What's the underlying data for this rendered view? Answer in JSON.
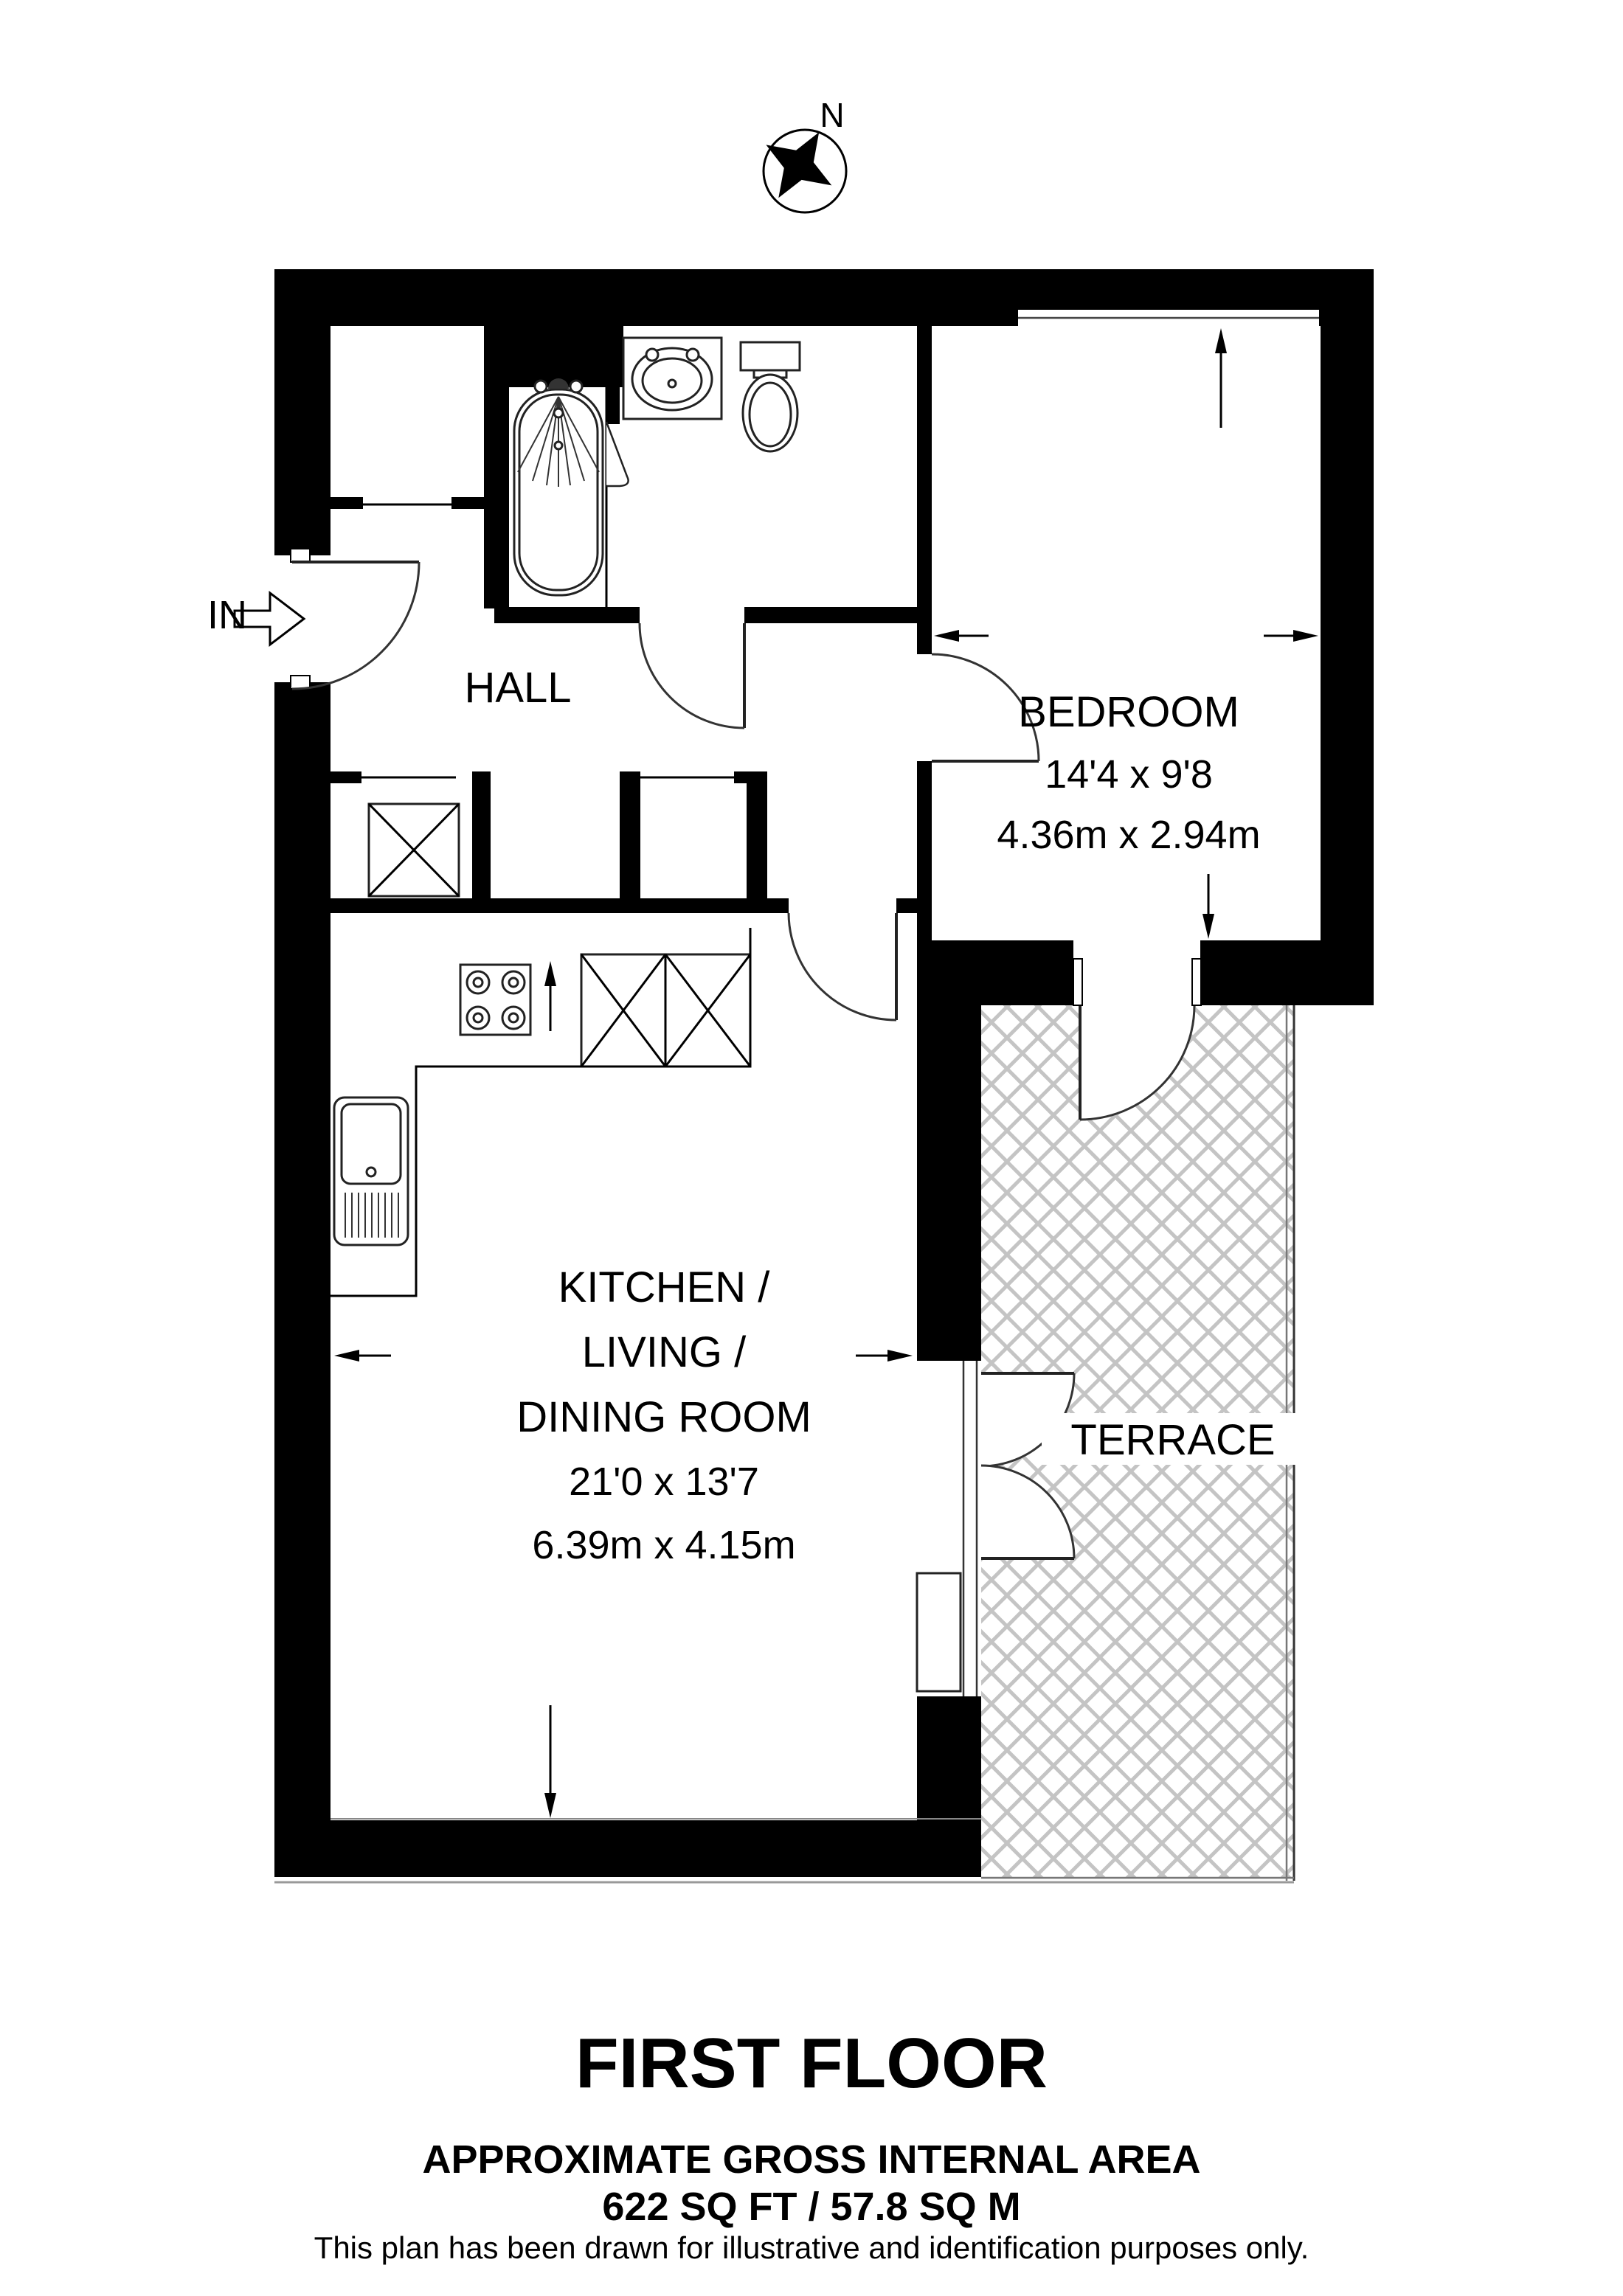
{
  "colors": {
    "wall": "#000000",
    "hatch": "#c4c4c4",
    "background": "#ffffff"
  },
  "compass": {
    "label": "N"
  },
  "entrance": {
    "label": "IN"
  },
  "rooms": {
    "hall": {
      "name": "HALL"
    },
    "bedroom": {
      "name": "BEDROOM",
      "dims_ft": "14'4 x 9'8",
      "dims_m": "4.36m x 2.94m"
    },
    "kitchen": {
      "name_line1": "KITCHEN /",
      "name_line2": "LIVING /",
      "name_line3": "DINING ROOM",
      "dims_ft": "21'0 x 13'7",
      "dims_m": "6.39m x 4.15m"
    },
    "terrace": {
      "name": "TERRACE"
    }
  },
  "footer": {
    "floor_title": "FIRST FLOOR",
    "area_heading": "APPROXIMATE GROSS INTERNAL AREA",
    "area_value": "622 SQ FT / 57.8 SQ M",
    "disclaimer": "This plan has been drawn for illustrative and identification purposes only."
  }
}
